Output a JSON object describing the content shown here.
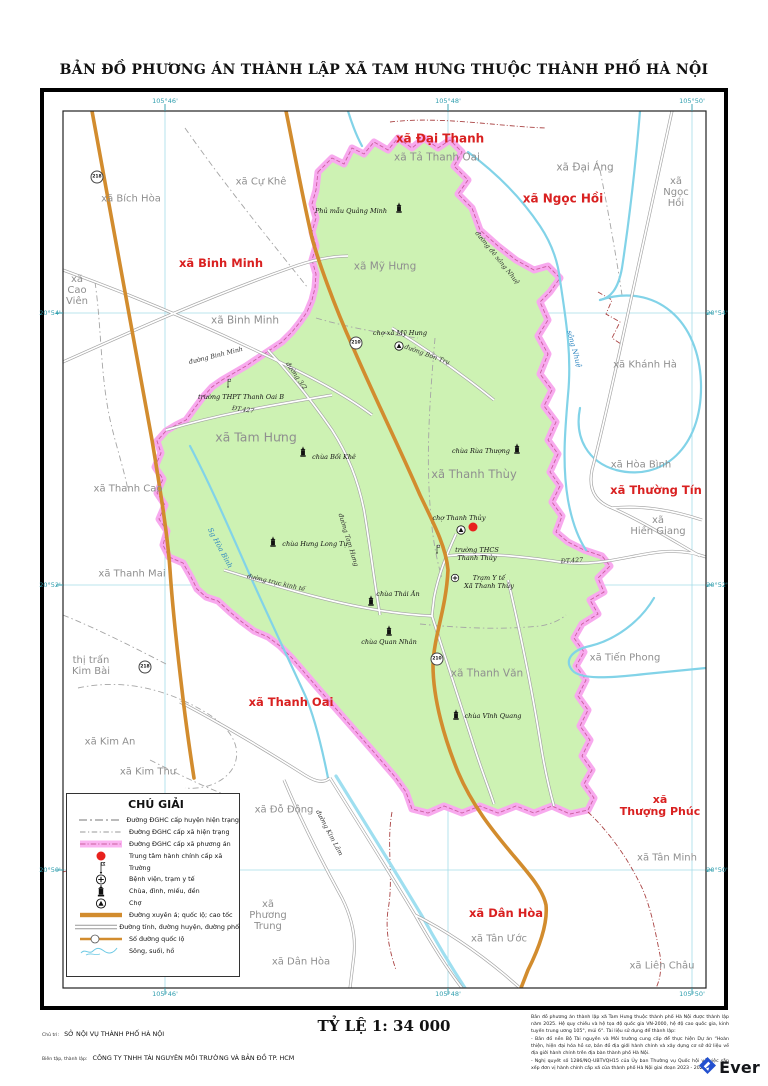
{
  "title": "BẢN ĐỒ PHƯƠNG ÁN THÀNH LẬP XÃ TAM HƯNG THUỘC THÀNH PHỐ HÀ NỘI",
  "colors": {
    "commune_fill": "#cdf2b3",
    "boundary_pink": "#f8a9ee",
    "highway_orange": "#d28c2e",
    "red_label": "#d92121",
    "gray_label": "#8f8f8f",
    "river": "#82d3e8",
    "graticule": "#2f9eae",
    "admin_center": "#e8211d"
  },
  "graticule": {
    "top": [
      {
        "t": "105°46'",
        "x": 165
      },
      {
        "t": "105°48'",
        "x": 448
      },
      {
        "t": "105°50'",
        "x": 692
      }
    ],
    "bottom": [
      {
        "t": "105°46'",
        "x": 165
      },
      {
        "t": "105°48'",
        "x": 448
      },
      {
        "t": "105°50'",
        "x": 692
      }
    ],
    "left": [
      {
        "t": "20°54'",
        "y": 313
      },
      {
        "t": "20°52'",
        "y": 585
      },
      {
        "t": "20°50'",
        "y": 870
      }
    ],
    "right": [
      {
        "t": "20°54'",
        "y": 313
      },
      {
        "t": "20°52'",
        "y": 585
      },
      {
        "t": "20°50'",
        "y": 870
      }
    ]
  },
  "map": {
    "region_labels": [
      {
        "t": "xã Đại Thanh",
        "x": 440,
        "y": 139,
        "c": "r",
        "s": 12
      },
      {
        "t": "xã Tả Thanh Oai",
        "x": 437,
        "y": 158,
        "c": "g",
        "s": 10.5
      },
      {
        "t": "xã Đại Áng",
        "x": 585,
        "y": 168,
        "c": "g",
        "s": 10.5
      },
      {
        "t": "xã Ngọc Hồi",
        "x": 563,
        "y": 199,
        "c": "r",
        "s": 12
      },
      {
        "lines": [
          "xã",
          "Ngọc",
          "Hồi"
        ],
        "x": 676,
        "y": 193,
        "c": "g",
        "s": 10
      },
      {
        "t": "xã Cự Khê",
        "x": 261,
        "y": 183,
        "c": "g",
        "s": 10
      },
      {
        "t": "xã Bích Hòa",
        "x": 131,
        "y": 200,
        "c": "g",
        "s": 10
      },
      {
        "t": "xã Binh Minh",
        "x": 221,
        "y": 263,
        "c": "r",
        "s": 11.5
      },
      {
        "lines": [
          "xã",
          "Cao",
          "Viên"
        ],
        "x": 77,
        "y": 291,
        "c": "g",
        "s": 10
      },
      {
        "t": "xã Binh Minh",
        "x": 245,
        "y": 321,
        "c": "g",
        "s": 10.5
      },
      {
        "t": "xã Mỹ Hưng",
        "x": 385,
        "y": 267,
        "c": "g",
        "s": 10.5
      },
      {
        "t": "xã Khánh Hà",
        "x": 645,
        "y": 366,
        "c": "g",
        "s": 10
      },
      {
        "t": "xã Hòa Bình",
        "x": 641,
        "y": 466,
        "c": "g",
        "s": 10
      },
      {
        "t": "xã Thường Tín",
        "x": 656,
        "y": 490,
        "c": "r",
        "s": 11.5
      },
      {
        "lines": [
          "xã",
          "Hiền Giang"
        ],
        "x": 658,
        "y": 527,
        "c": "g",
        "s": 10
      },
      {
        "t": "xã Thanh Cao",
        "x": 128,
        "y": 490,
        "c": "g",
        "s": 10
      },
      {
        "t": "xã Tam Hưng",
        "x": 256,
        "y": 437,
        "c": "g",
        "s": 12.5
      },
      {
        "t": "xã Thanh Thùy",
        "x": 474,
        "y": 474,
        "c": "g",
        "s": 11.5
      },
      {
        "t": "xã Thanh Mai",
        "x": 132,
        "y": 575,
        "c": "g",
        "s": 10
      },
      {
        "lines": [
          "thị trấn",
          "Kim Bài"
        ],
        "x": 91,
        "y": 667,
        "c": "g",
        "s": 10
      },
      {
        "t": "xã Tiến Phong",
        "x": 625,
        "y": 659,
        "c": "g",
        "s": 10
      },
      {
        "t": "xã Thanh Văn",
        "x": 487,
        "y": 674,
        "c": "g",
        "s": 10.5
      },
      {
        "t": "xã Thanh Oai",
        "x": 291,
        "y": 702,
        "c": "r",
        "s": 11.5
      },
      {
        "t": "xã Kim An",
        "x": 110,
        "y": 743,
        "c": "g",
        "s": 10
      },
      {
        "t": "xã Kim Thư",
        "x": 148,
        "y": 773,
        "c": "g",
        "s": 10
      },
      {
        "t": "xã Đỗ Động",
        "x": 284,
        "y": 811,
        "c": "g",
        "s": 10
      },
      {
        "lines": [
          "xã",
          "Thượng Phúc"
        ],
        "x": 660,
        "y": 806,
        "c": "r",
        "s": 11
      },
      {
        "t": "xã Tân Minh",
        "x": 667,
        "y": 859,
        "c": "g",
        "s": 10
      },
      {
        "lines": [
          "xã",
          "Phương",
          "Trung"
        ],
        "x": 268,
        "y": 916,
        "c": "g",
        "s": 10
      },
      {
        "t": "xã Dân Hòa",
        "x": 506,
        "y": 913,
        "c": "r",
        "s": 11.5
      },
      {
        "t": "xã Tân Ước",
        "x": 499,
        "y": 940,
        "c": "g",
        "s": 10
      },
      {
        "t": "xã Dân Hòa",
        "x": 301,
        "y": 963,
        "c": "g",
        "s": 10
      },
      {
        "t": "xã Liên Châu",
        "x": 662,
        "y": 967,
        "c": "g",
        "s": 10
      }
    ],
    "poi_labels": [
      {
        "icon": "temple",
        "ix": 399,
        "iy": 208,
        "t": "Phủ mẫu Quảng Minh",
        "tx": 351,
        "ty": 212
      },
      {
        "icon": "market",
        "ix": 399,
        "iy": 346,
        "t": "chợ xã Mỹ Hưng",
        "tx": 400,
        "ty": 334
      },
      {
        "icon": "temple",
        "ix": 303,
        "iy": 452,
        "t": "chùa Bối Khê",
        "tx": 334,
        "ty": 458
      },
      {
        "icon": "temple",
        "ix": 517,
        "iy": 449,
        "t": "chùa Rùa Thượng",
        "tx": 481,
        "ty": 452
      },
      {
        "icon": "market",
        "ix": 461,
        "iy": 530,
        "t": "chợ Thanh Thủy",
        "tx": 459,
        "ty": 519
      },
      {
        "icon": "school",
        "ix": 437,
        "iy": 549,
        "lines": [
          "trường THCS",
          "Thanh Thủy"
        ],
        "tx": 477,
        "ty": 555
      },
      {
        "icon": "health",
        "ix": 455,
        "iy": 578,
        "lines": [
          "Trạm Y tế",
          "Xã Thanh Thủy"
        ],
        "tx": 489,
        "ty": 583
      },
      {
        "icon": "temple",
        "ix": 273,
        "iy": 542,
        "t": "chùa Hưng Long Tự",
        "tx": 315,
        "ty": 545
      },
      {
        "icon": "temple",
        "ix": 371,
        "iy": 601,
        "t": "chùa Thái Ân",
        "tx": 398,
        "ty": 595
      },
      {
        "icon": "temple",
        "ix": 389,
        "iy": 631,
        "t": "chùa Quan Nhân",
        "tx": 389,
        "ty": 643
      },
      {
        "icon": "temple",
        "ix": 456,
        "iy": 715,
        "t": "chùa Vĩnh Quang",
        "tx": 493,
        "ty": 717
      },
      {
        "icon": "school",
        "ix": 228,
        "iy": 383,
        "t": "trường THPT Thanh Oai B",
        "tx": 241,
        "ty": 398
      }
    ],
    "road_labels": [
      {
        "t": "đường Binh Minh",
        "x": 216,
        "y": 356,
        "r": -14
      },
      {
        "t": "đường 3/2",
        "x": 296,
        "y": 376,
        "r": 55
      },
      {
        "t": "ĐT.427",
        "x": 243,
        "y": 410,
        "r": 8
      },
      {
        "t": "đường Bốn Trụ",
        "x": 427,
        "y": 355,
        "r": 20
      },
      {
        "t": "đường đê sông Nhuệ",
        "x": 497,
        "y": 258,
        "r": 51
      },
      {
        "t": "đường Tam Hưng",
        "x": 348,
        "y": 540,
        "r": 73
      },
      {
        "t": "đường trục kinh tế",
        "x": 276,
        "y": 583,
        "r": 13
      },
      {
        "t": "ĐT.427",
        "x": 572,
        "y": 561,
        "r": -4
      },
      {
        "t": "đường Kim Lâm",
        "x": 329,
        "y": 833,
        "r": 62
      },
      {
        "t": "sông Nhuệ",
        "x": 574,
        "y": 349,
        "r": 75,
        "b": 1
      },
      {
        "t": "Sg Hòa Bình",
        "x": 220,
        "y": 548,
        "r": 62,
        "b": 1
      }
    ],
    "route_badges": [
      {
        "n": "218",
        "x": 97,
        "y": 177
      },
      {
        "n": "218",
        "x": 145,
        "y": 667
      },
      {
        "n": "210",
        "x": 356,
        "y": 343
      },
      {
        "n": "210",
        "x": 437,
        "y": 659
      }
    ],
    "admin_center": {
      "x": 473,
      "y": 527
    }
  },
  "legend": {
    "title": "CHÚ GIẢI",
    "items": [
      {
        "sym": "huyen_line",
        "label": "Đường ĐGHC cấp huyện hiện trạng"
      },
      {
        "sym": "xa_line",
        "label": "Đường ĐGHC cấp xã hiện trạng"
      },
      {
        "sym": "pink_band",
        "label": "Đường ĐGHC cấp xã phương án"
      },
      {
        "sym": "red_dot",
        "label": "Trung tâm hành chính cấp xã"
      },
      {
        "sym": "school",
        "label": "Trường"
      },
      {
        "sym": "health",
        "label": "Bệnh viện, trạm y tế"
      },
      {
        "sym": "temple",
        "label": "Chùa, đình, miếu, đền"
      },
      {
        "sym": "market",
        "label": "Chợ"
      },
      {
        "sym": "highway",
        "label": "Đường xuyên á; quốc lộ; cao tốc"
      },
      {
        "sym": "road",
        "label": "Đường tỉnh, đường huyện, đường phố"
      },
      {
        "sym": "route_num",
        "label": "Số đường quốc lộ"
      },
      {
        "sym": "river",
        "label": "Sông, suối, hồ"
      }
    ]
  },
  "footer": {
    "line1_prefix": "Chủ trì:",
    "line1": "SỞ NỘI VỤ THÀNH PHỐ HÀ NỘI",
    "line2_prefix": "Biên tập, thành lập:",
    "line2": "CÔNG TY TNHH TÀI NGUYÊN MÔI TRƯỜNG VÀ BẢN ĐỒ TP. HCM",
    "scale": "TỶ LỆ 1: 34 000",
    "logo": "Ever",
    "notes": [
      "Bản đồ phương án thành lập xã Tam Hưng thuộc thành phố Hà Nội được thành lập năm 2025. Hệ quy chiếu và hệ tọa độ quốc gia VN-2000, hệ độ cao quốc gia, kinh tuyến trung ương 105°, múi 6°. Tài liệu sử dụng để thành lập:",
      "- Bản đồ nền Bộ Tài nguyên và Môi trường cung cấp để thực hiện Dự án “Hoàn thiện, hiện đại hóa hồ sơ, bản đồ địa giới hành chính và xây dựng cơ sở dữ liệu về địa giới hành chính trên địa bàn thành phố Hà Nội.",
      "- Nghị quyết số 1286/NQ-UBTVQH15 của Ủy ban Thường vụ Quốc hội về việc sắp xếp đơn vị hành chính cấp xã của thành phố Hà Nội giai đoạn 2023 - 2025."
    ]
  }
}
